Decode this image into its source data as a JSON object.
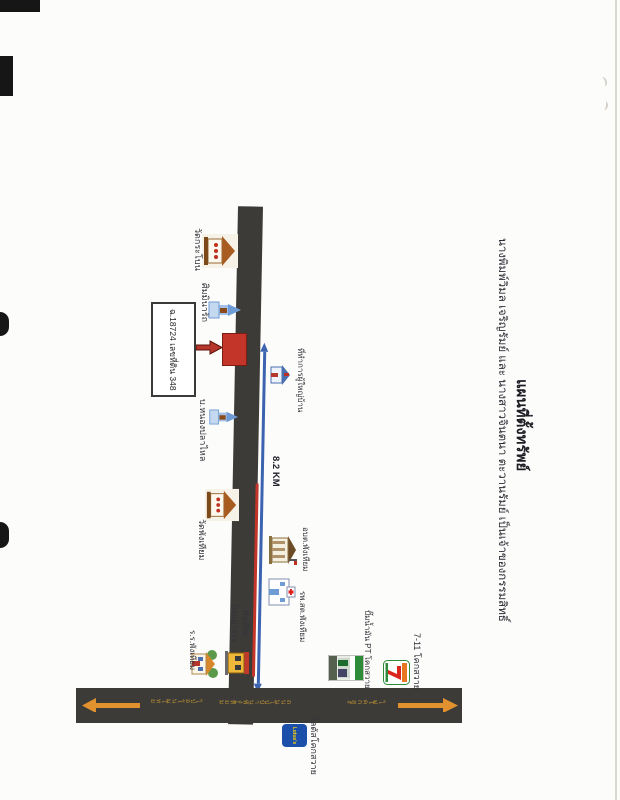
{
  "page": {
    "title": "แผนที่ตั้งทรัพย์",
    "owner_line": "นางพิมพ์วิมล เจริญรัมย์ และ นางสาวจินตนา ตะวานรัมย์ เป็นเจ้าของกรรมสิทธิ์"
  },
  "parcel": {
    "box_label": "ฉ.18724 เลขที่ดิน 348"
  },
  "distance": {
    "label": "8.2 KM"
  },
  "landmarks": {
    "wat_krabon": "วัดกระโบน",
    "sala_minarat": "ศิมมินารัถ",
    "ban_nong_pla_lai": "บ.หนองปลาไหล",
    "headman_office": "ที่ทำการผู้ใหญ่บ้าน",
    "wat_phang_thiam": "วัดพังเทียม",
    "obt_phang_thiam": "อบต.พังเทียม",
    "hospital": "รพ.สต.พังเทียม",
    "school": "ร.ร.พังเทียม",
    "police_line1": "ป้อมตำรวจ",
    "police_line2": "พังเทียม",
    "pt_station": "ปั๊มน้ำมัน PT โคกสวาย",
    "seven_eleven": "7-11 โคกสวาย",
    "lotus": "โลตัสโคกสวาย"
  },
  "road_labels": {
    "left": "ไปอ.โนนไทย",
    "middle": "ถนนไปบ้านพังเทียม",
    "right": "ไปโคกสูง"
  },
  "logos": {
    "seven": "7",
    "lotus": "Lotus's"
  },
  "colors": {
    "road": "#3d3b38",
    "route_blue": "#3c63b0",
    "marker_red": "#c23528",
    "arrow_orange": "#e2912f"
  }
}
